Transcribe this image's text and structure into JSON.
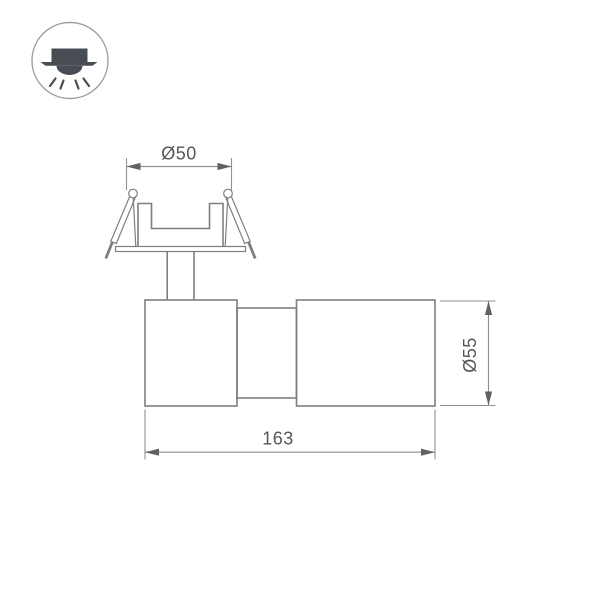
{
  "colors": {
    "background": "#ffffff",
    "object_line": "#7d7f82",
    "dimension_line": "#8f9194",
    "dimension_text": "#55565a",
    "arrow": "#5f6165",
    "icon_outline": "#9aa0a4",
    "icon_glyph": "#484d53"
  },
  "icon_badge": {
    "name": "recessed-downlight-icon",
    "parts": [
      "housing-block",
      "ceiling-line",
      "lamp-dome",
      "light-rays"
    ]
  },
  "drawing": {
    "type": "dimensioned technical side view of recessed swivel spotlight",
    "dimensions": {
      "cutout_diameter": {
        "label": "Ø50",
        "orientation": "horizontal-top"
      },
      "body_diameter": {
        "label": "Ø55",
        "orientation": "vertical-right-rotated"
      },
      "overall_length": {
        "label": "163",
        "orientation": "horizontal-bottom"
      }
    }
  }
}
